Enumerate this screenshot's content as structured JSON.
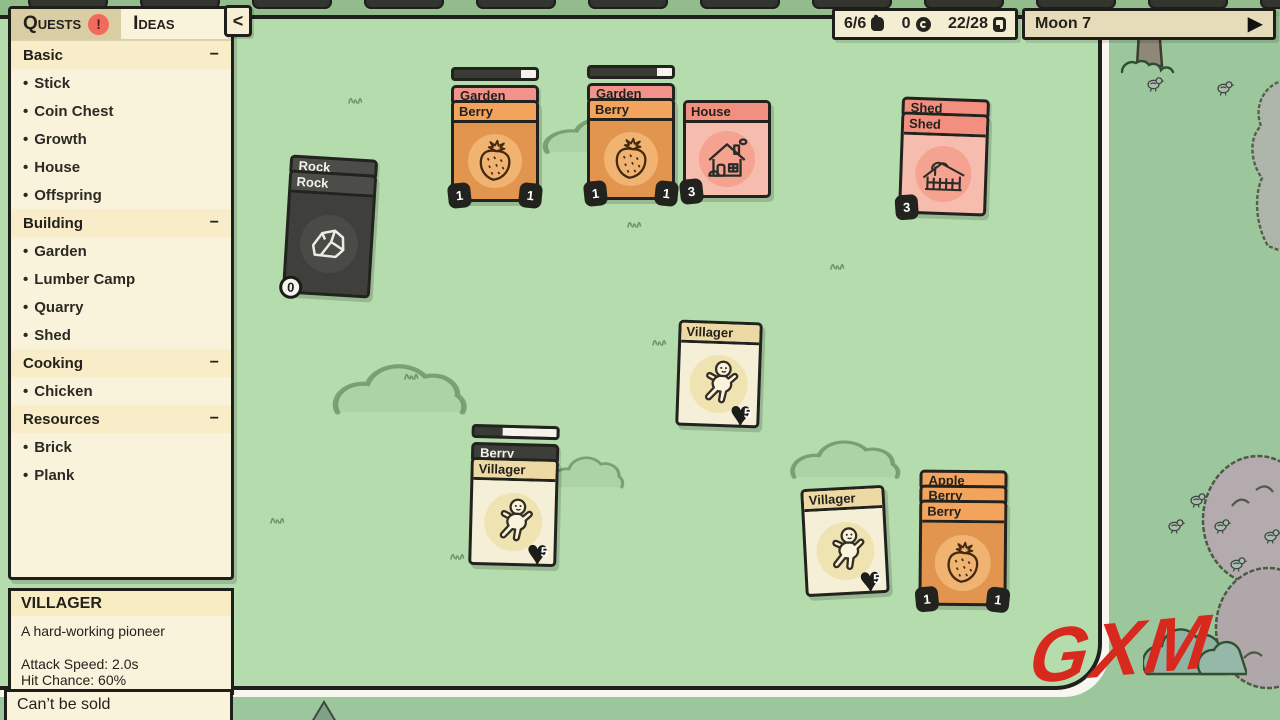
{
  "icons": {
    "play": "▶",
    "collapse": "<",
    "minus": "−",
    "bullet": "•",
    "exclaim": "!",
    "heart": "♥"
  },
  "top_bar": {
    "food": "6/6",
    "coins": "0",
    "cards": "22/28",
    "moon_label": "Moon 7"
  },
  "sidebar": {
    "tabs": [
      {
        "label": "Quests"
      },
      {
        "label": "Ideas"
      }
    ],
    "sections": [
      {
        "label": "Basic",
        "items": [
          "Stick",
          "Coin Chest",
          "Growth",
          "House",
          "Offspring"
        ]
      },
      {
        "label": "Building",
        "items": [
          "Garden",
          "Lumber Camp",
          "Quarry",
          "Shed"
        ]
      },
      {
        "label": "Cooking",
        "items": [
          "Chicken"
        ]
      },
      {
        "label": "Resources",
        "items": [
          "Brick",
          "Plank"
        ]
      }
    ]
  },
  "info_panel": {
    "title": "VILLAGER",
    "description": "A hard-working pioneer",
    "stat_attack": "Attack Speed: 2.0s",
    "stat_hit": "Hit Chance: 60%"
  },
  "tooltip": {
    "text": "Can’t be sold"
  },
  "watermark": {
    "text": "GXM"
  },
  "board": {
    "stacks": {
      "rock": {
        "back_title": "Rock",
        "title": "Rock",
        "count": "0"
      },
      "garden1": {
        "back_title": "Garden",
        "title": "Berry",
        "progress_css": "width:18%",
        "badge_left": "1",
        "badge_right": "1"
      },
      "garden2": {
        "back_title": "Garden",
        "title": "Berry",
        "progress_css": "width:18%",
        "badge_left": "1",
        "badge_right": "1"
      },
      "house": {
        "title": "House",
        "badge_left": "3"
      },
      "shed": {
        "back_title": "Shed",
        "title": "Shed",
        "badge_left": "3"
      },
      "villager_center": {
        "title": "Villager",
        "health": "5"
      },
      "berry_bush": {
        "back_title": "Berry Bush",
        "title": "Villager",
        "progress_css": "width:66%",
        "health": "5"
      },
      "villager_south": {
        "title": "Villager",
        "health": "5"
      },
      "apple_stack": {
        "back_title_1": "Apple",
        "back_title_2": "Berry",
        "title": "Berry",
        "badge_left": "1",
        "badge_right": "1"
      }
    }
  },
  "colors": {
    "board_green": "#b5dcad",
    "outside_green": "#9cc69b",
    "panel_cream": "#f9f3dc",
    "card_orange": "#e2954f",
    "bar_pink": "#f2938b",
    "bar_orange": "#f2a35c",
    "card_pink": "#f6bcae",
    "bar_salmon": "#f28f7f",
    "card_cream": "#f6efd8",
    "bar_tan": "#ecd9a4",
    "card_dark": "#3f3f3c",
    "quest_badge_red": "#f26a5c",
    "watermark_red": "#d7291d"
  }
}
